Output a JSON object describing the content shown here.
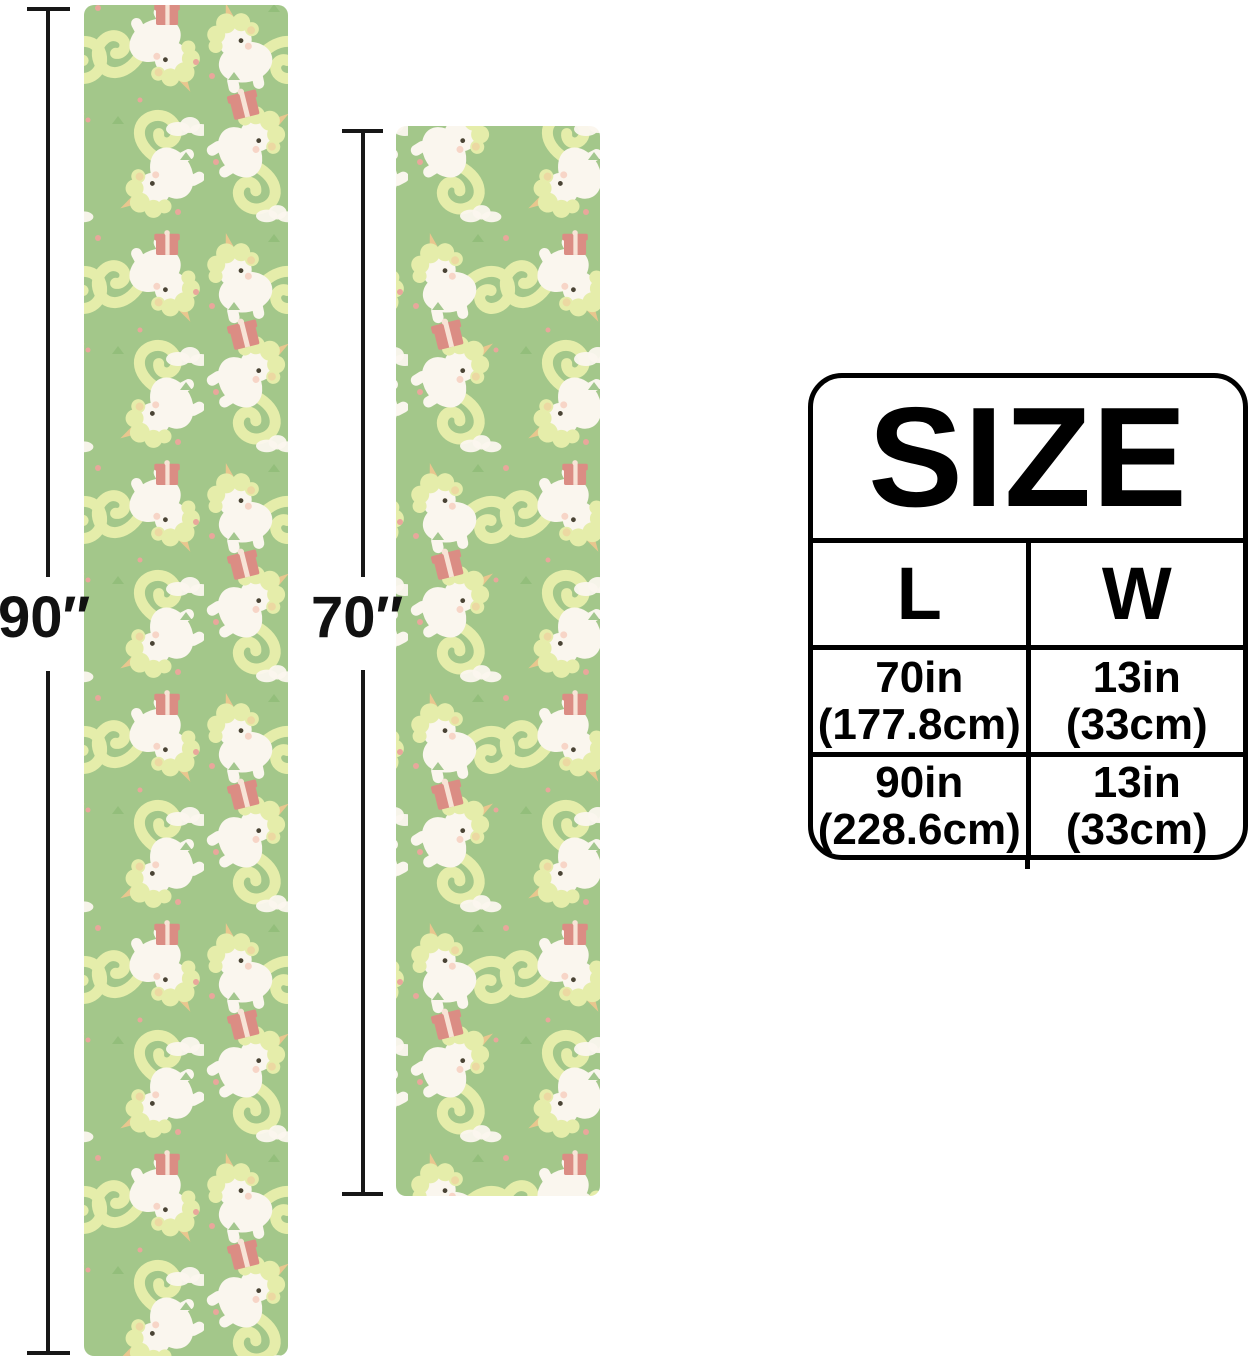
{
  "page": {
    "background": "#ffffff"
  },
  "fabric": {
    "motif": "cartoon unicorns with swirly tails, gifts, clouds and dots on green",
    "colors": {
      "background": "#a3c78a",
      "unicorn_body": "#faf6ee",
      "mane": "#e5edaa",
      "mane_accent": "#eed3a0",
      "horn": "#e9c68e",
      "eye": "#4a4435",
      "blush": "#f3b9a8",
      "gift": "#db8d84",
      "gift_ribbon": "#f7e3d6",
      "dot": "#e9a79b",
      "leaf": "#8fbb77"
    }
  },
  "measurements": {
    "left": {
      "label": "90″"
    },
    "right": {
      "label": "70″"
    }
  },
  "size_table": {
    "title": "SIZE",
    "columns": [
      "L",
      "W"
    ],
    "rows": [
      {
        "l": [
          "70in",
          "(177.8cm)"
        ],
        "w": [
          "13in",
          "(33cm)"
        ]
      },
      {
        "l": [
          "90in",
          "(228.6cm)"
        ],
        "w": [
          "13in",
          "(33cm)"
        ]
      }
    ]
  }
}
